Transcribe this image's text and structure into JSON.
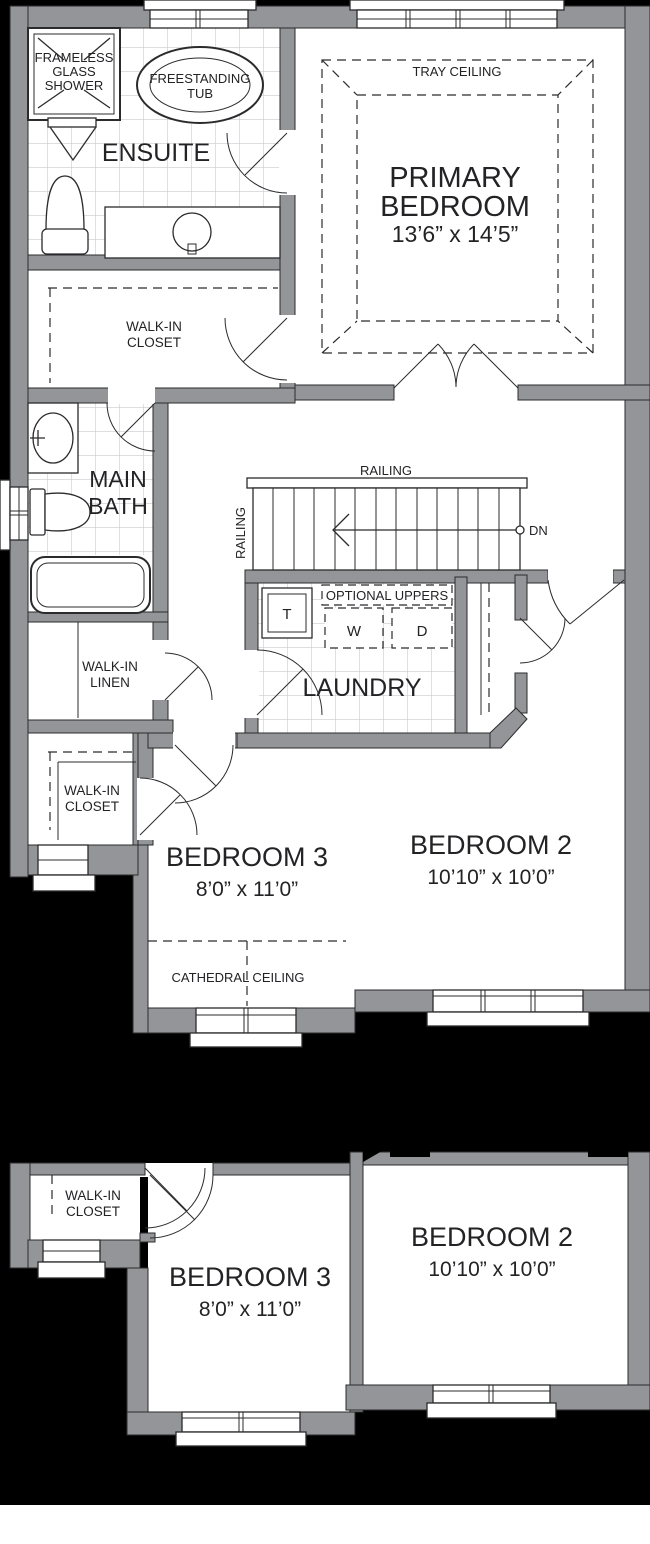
{
  "colors": {
    "background": "#000000",
    "wall_fill": "#939598",
    "floor_fill": "#ffffff",
    "line": "#2b2b2d",
    "tile_grid": "#c9cbce"
  },
  "upper_plan": {
    "ensuite": {
      "name": "ENSUITE"
    },
    "shower": {
      "line1": "FRAMELESS",
      "line2": "GLASS",
      "line3": "SHOWER"
    },
    "tub": {
      "line1": "FREESTANDING",
      "line2": "TUB"
    },
    "primary_bedroom": {
      "line1": "PRIMARY",
      "line2": "BEDROOM",
      "dims": "13’6” x 14’5”",
      "ceiling": "TRAY CEILING"
    },
    "walk_in_closet": {
      "line1": "WALK-IN",
      "line2": "CLOSET"
    },
    "main_bath": {
      "line1": "MAIN",
      "line2": "BATH"
    },
    "walk_in_linen": {
      "line1": "WALK-IN",
      "line2": "LINEN"
    },
    "bedroom3_closet": {
      "line1": "WALK-IN",
      "line2": "CLOSET"
    },
    "stairs": {
      "railing_top": "RAILING",
      "railing_side": "RAILING",
      "direction": "DN"
    },
    "laundry": {
      "name": "LAUNDRY",
      "uppers": "OPTIONAL UPPERS",
      "laundry_tub": "T",
      "washer": "W",
      "dryer": "D"
    },
    "bedroom3": {
      "name": "BEDROOM 3",
      "dims": "8’0” x 11’0”",
      "ceiling": "CATHEDRAL CEILING"
    },
    "bedroom2": {
      "name": "BEDROOM 2",
      "dims": "10’10” x 10’0”"
    }
  },
  "option_plan": {
    "closet": {
      "line1": "WALK-IN",
      "line2": "CLOSET"
    },
    "bedroom3": {
      "name": "BEDROOM 3",
      "dims": "8’0” x 11’0”"
    },
    "bedroom2": {
      "name": "BEDROOM 2",
      "dims": "10’10” x 10’0”"
    }
  }
}
